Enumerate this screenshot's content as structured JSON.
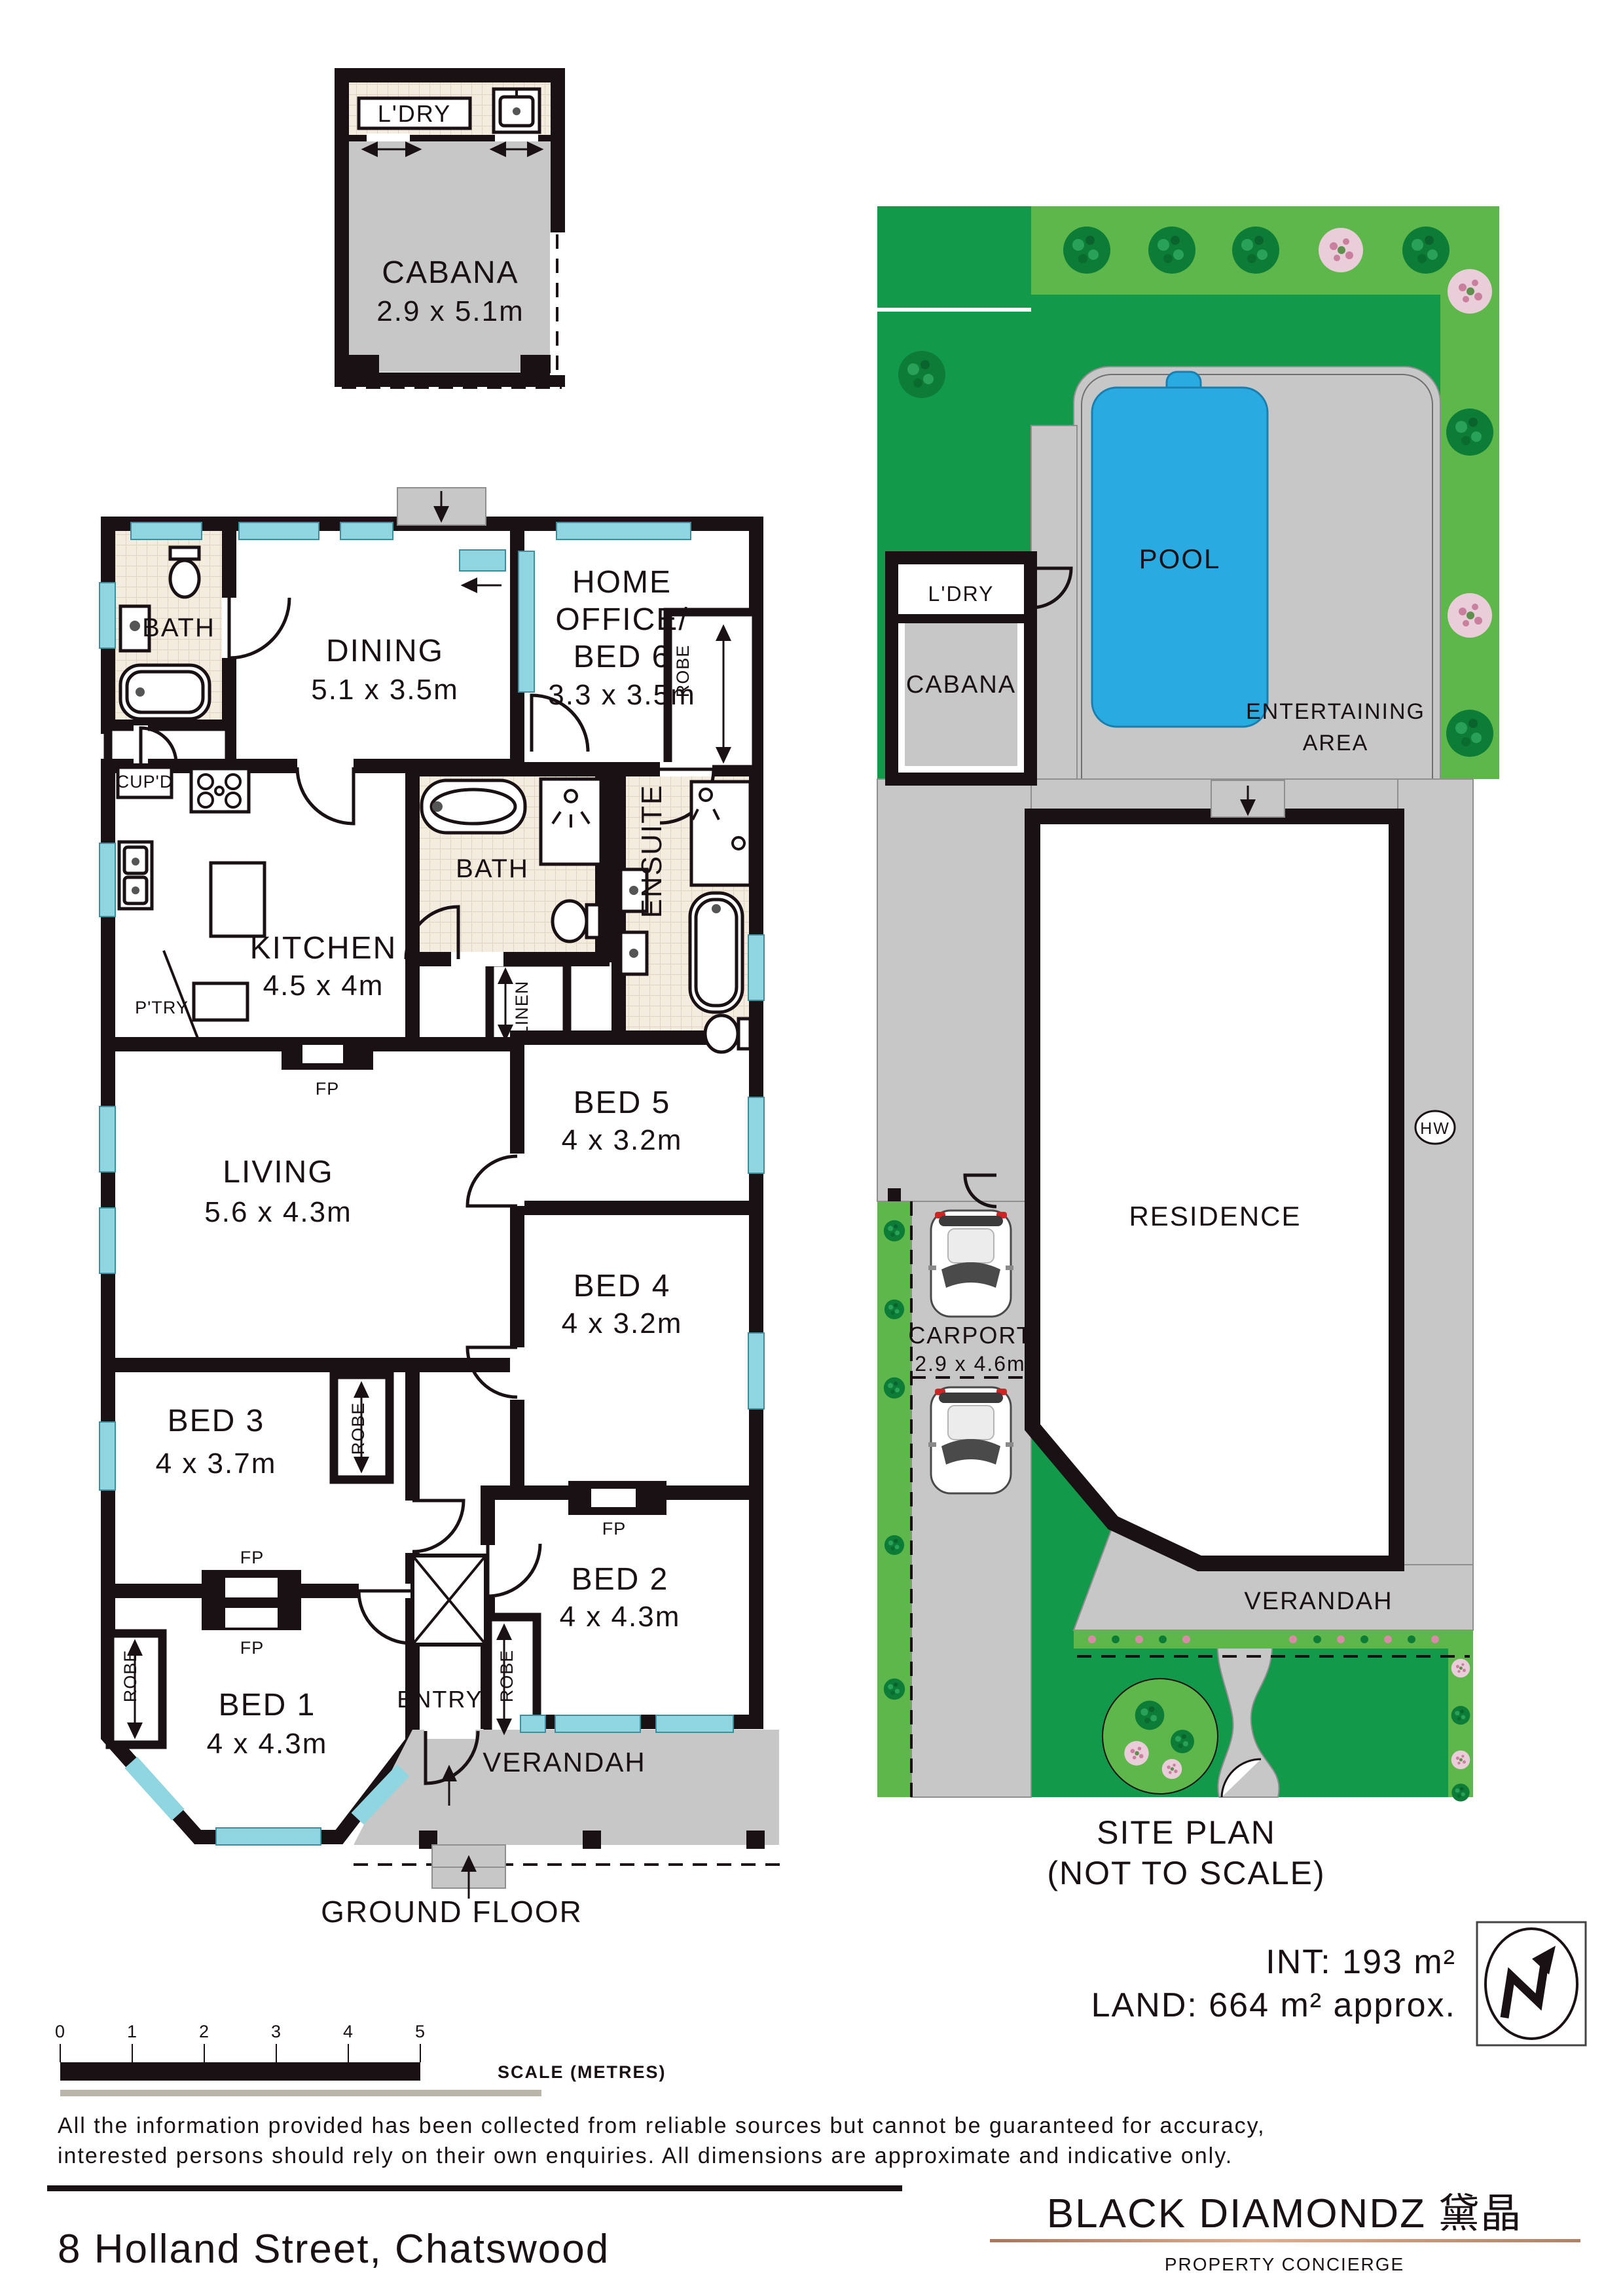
{
  "cabana": {
    "ldry": "L'DRY",
    "name": "CABANA",
    "dims": "2.9 x 5.1m"
  },
  "floor": {
    "title": "GROUND FLOOR",
    "bath_top": "BATH",
    "dining": "DINING",
    "dining_dims": "5.1 x 3.5m",
    "home_office_1": "HOME",
    "home_office_2": "OFFICE/",
    "home_office_3": "BED 6",
    "home_office_dims": "3.3 x 3.5m",
    "robe_bed6": "ROBE",
    "cupd": "CUP'D",
    "kitchen": "KITCHEN",
    "kitchen_dims": "4.5 x 4m",
    "ptry": "P'TRY",
    "bath_mid": "BATH",
    "linen": "LINEN",
    "ensuite": "ENSUITE",
    "living": "LIVING",
    "living_dims": "5.6 x 4.3m",
    "fp_living": "FP",
    "bed5": "BED 5",
    "bed5_dims": "4 x 3.2m",
    "bed4": "BED 4",
    "bed4_dims": "4 x 3.2m",
    "bed3": "BED 3",
    "bed3_dims": "4 x 3.7m",
    "robe_bed3": "ROBE",
    "fp_bed3": "FP",
    "fp_bed1": "FP",
    "bed2": "BED 2",
    "bed2_dims": "4 x 4.3m",
    "robe_bed2": "ROBE",
    "fp_bed2": "FP",
    "bed1": "BED 1",
    "bed1_dims": "4 x 4.3m",
    "robe_bed1": "ROBE",
    "entry": "ENTRY",
    "verandah": "VERANDAH"
  },
  "site": {
    "title": "SITE PLAN",
    "subtitle": "(NOT TO SCALE)",
    "pool": "POOL",
    "ldry": "L'DRY",
    "cabana": "CABANA",
    "entertaining_1": "ENTERTAINING",
    "entertaining_2": "AREA",
    "residence": "RESIDENCE",
    "hw": "HW",
    "carport": "CARPORT",
    "carport_dims": "2.9 x 4.6m",
    "verandah": "VERANDAH"
  },
  "areas": {
    "int": "INT: 193 m²",
    "land": "LAND: 664 m² approx."
  },
  "scalebar": {
    "ticks": [
      "0",
      "1",
      "2",
      "3",
      "4",
      "5"
    ],
    "label": "SCALE (METRES)"
  },
  "disclaimer": {
    "line1": "All the information provided has been collected from reliable sources but cannot be guaranteed for accuracy,",
    "line2": "interested persons should rely on their own enquiries. All dimensions are approximate and indicative only."
  },
  "footer": {
    "address": "8 Holland Street, Chatswood"
  },
  "brand": {
    "name": "BLACK DIAMONDZ 黛晶",
    "tagline": "PROPERTY CONCIERGE"
  },
  "colors": {
    "wall": "#1a1114",
    "window": "#8fd6e0",
    "pool": "#29abe2",
    "lawn_light": "#5eb74b",
    "lawn_dark": "#12994a",
    "paving": "#c7c7c7",
    "brand_copper": "#c08a68"
  }
}
